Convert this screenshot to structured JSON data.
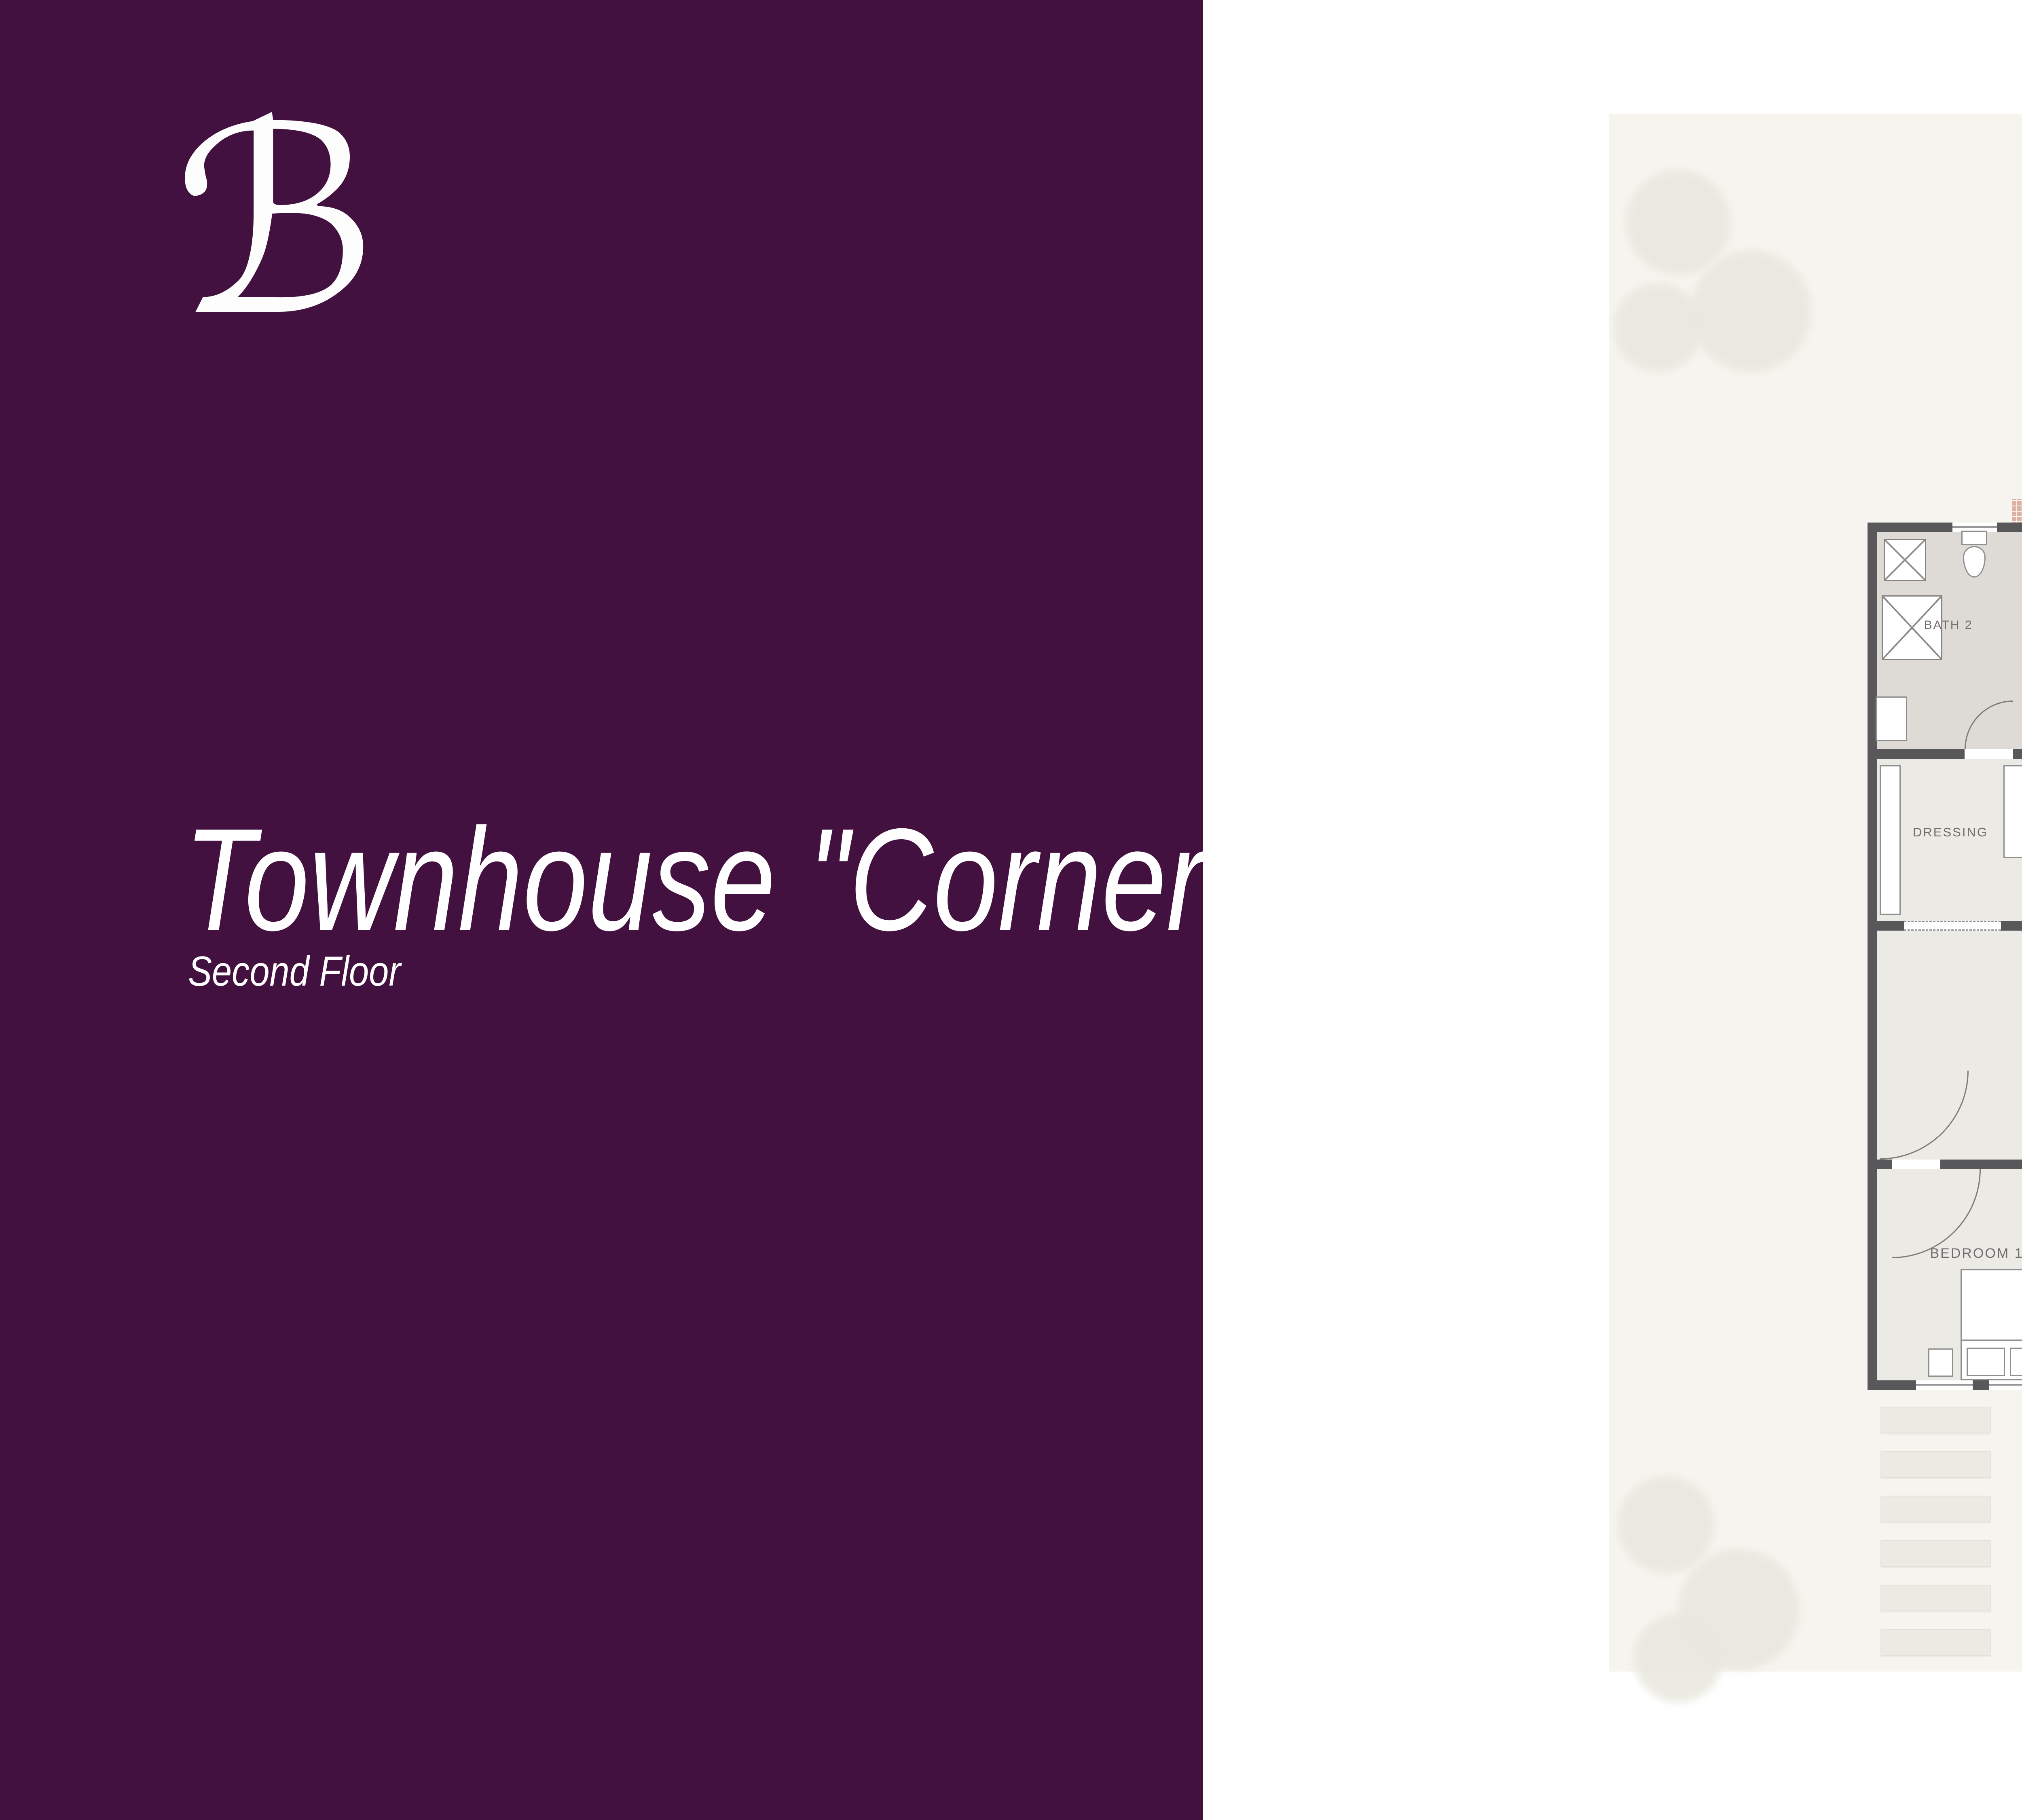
{
  "brand": {
    "logo_glyph": "ℬ"
  },
  "panel": {
    "title": "Townhouse \"Corner\"",
    "subtitle": "Second Floor"
  },
  "floor_plan": {
    "labels": {
      "terrace": "TERRACE",
      "bath2": "BATH 2",
      "bedroom2": "BEDROOM 2",
      "dressing": "DRESSING",
      "bedroom1": "BEDROOM 1",
      "bath1": "BATH1"
    }
  },
  "site_plan": {
    "corner_terrace_label": "TERRACE",
    "labels": {
      "bedroom2": "BEDROOM 2",
      "dressing": "DRESSING",
      "bath2": "BATH2",
      "bedroom1": "BEDROOM1",
      "bath": "BATH"
    }
  },
  "table": {
    "headers": [
      "ROOM",
      "LENGTH",
      "WIDTH"
    ],
    "rows": [
      [
        "BEDROOM 1",
        "3.20",
        "3.20"
      ],
      [
        "BATH 1",
        "2.20",
        "1.65"
      ],
      [
        "BEDROOM 2",
        "4.50",
        "3.00"
      ],
      [
        "BATH 2",
        "2.25",
        "1.85"
      ],
      [
        "DRESSING",
        "1.85",
        "1.85"
      ],
      [
        "TERRACE",
        "1.55",
        "3.00"
      ]
    ]
  },
  "colors": {
    "panel": "#431140",
    "accent-pink": "#DDB4A8",
    "wall": "#58585B"
  }
}
